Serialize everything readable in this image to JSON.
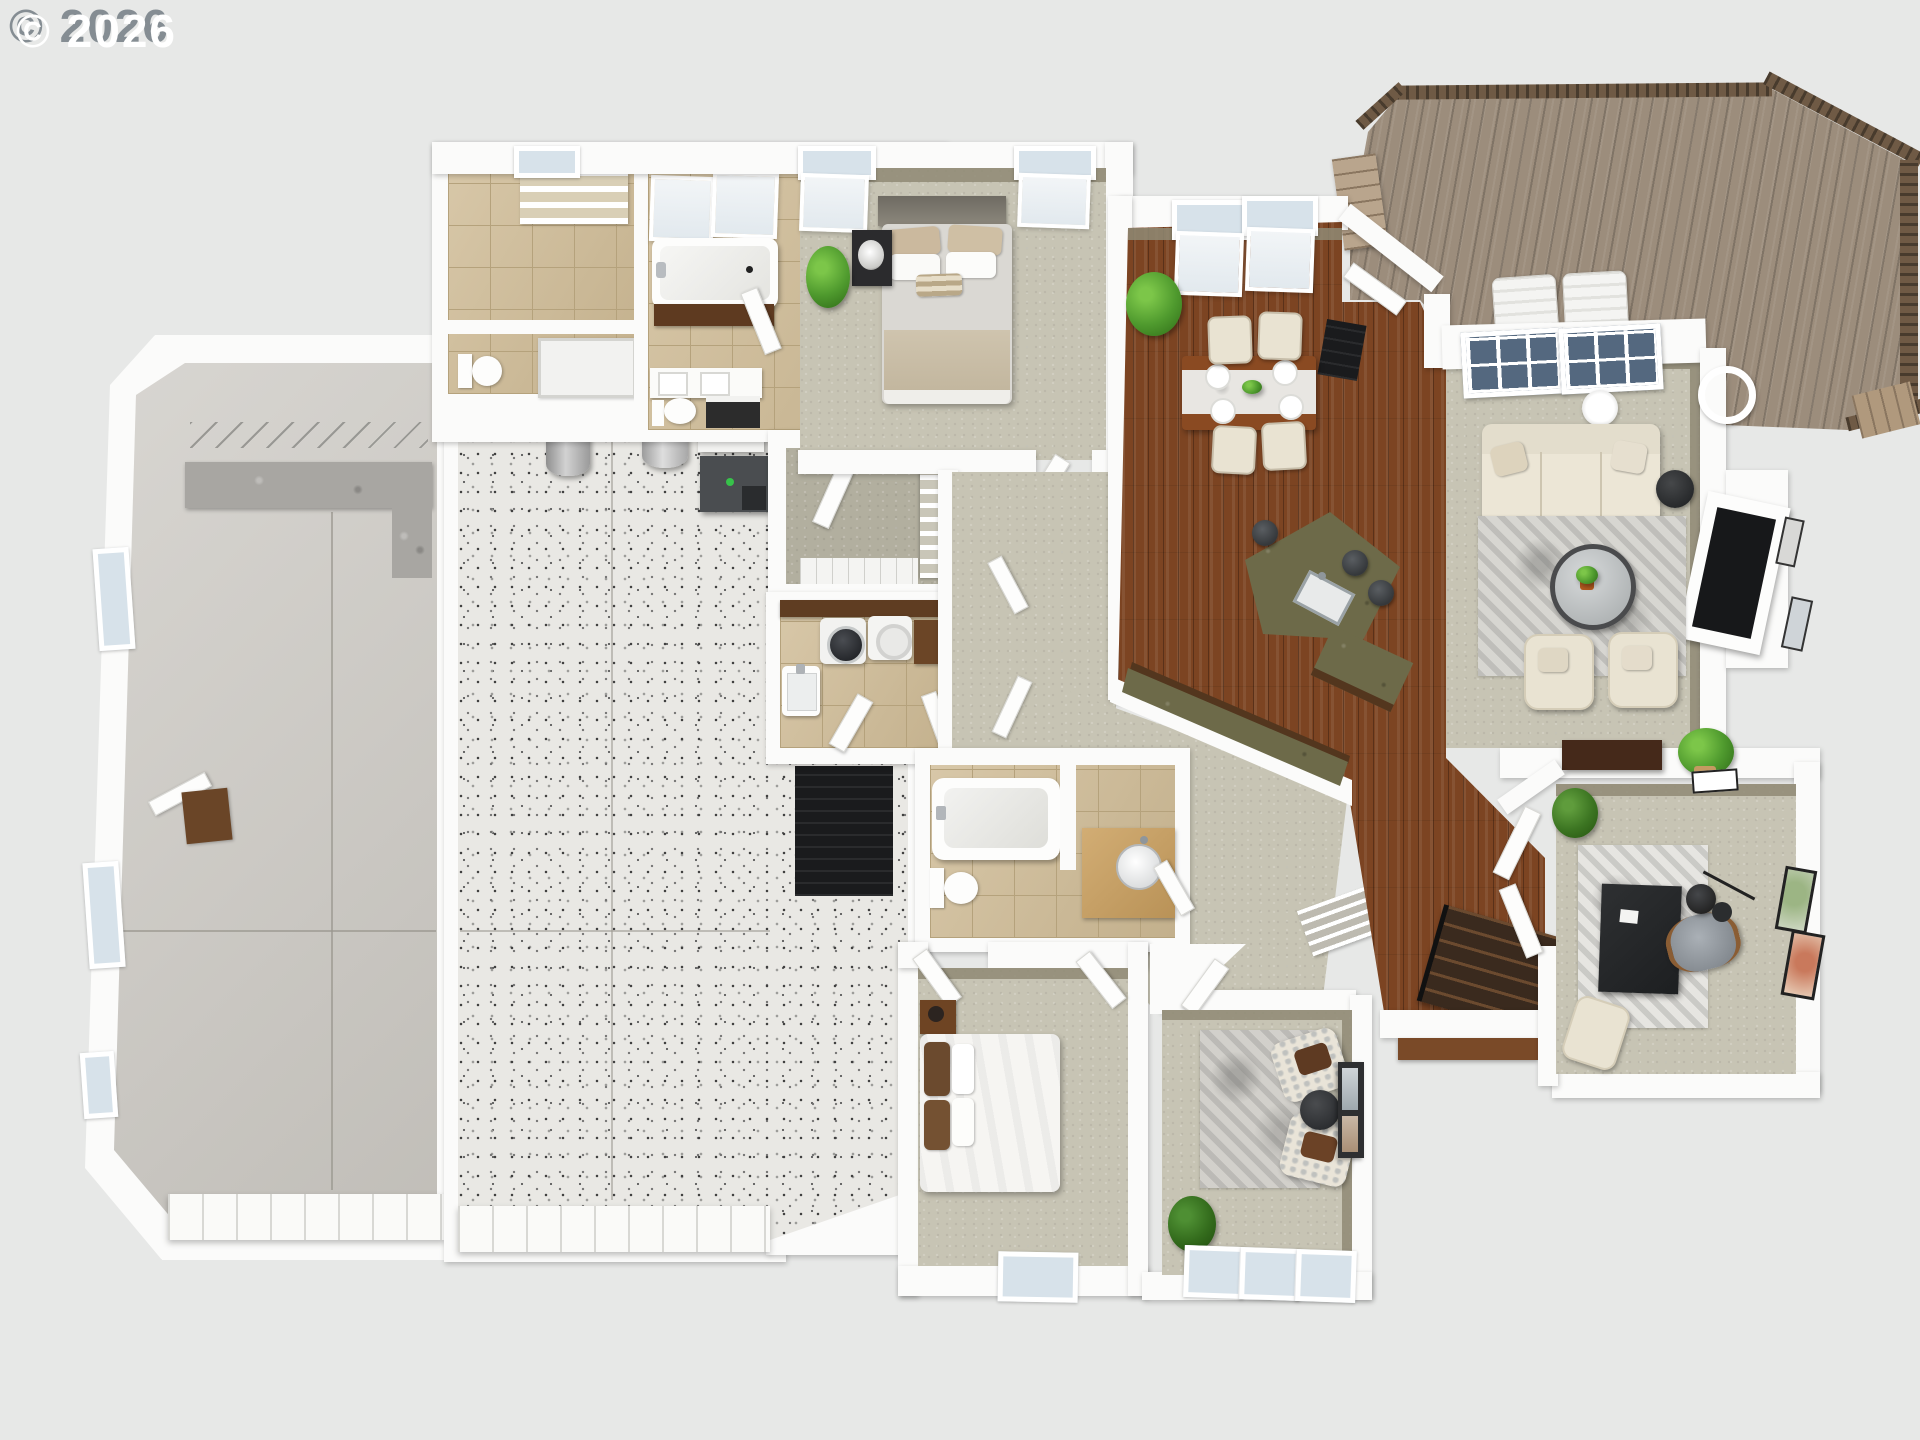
{
  "watermark": {
    "text": "© 2026"
  },
  "palette": {
    "bg": "#e7e8e7",
    "wall": "#fbfbfa",
    "inner_wall": "#8f8a74",
    "concrete": "#cbc8c2",
    "terrazzo": "#e9e8e4",
    "tile": "#cfbb95",
    "tile_line": "#b5a27c",
    "carpet": "#c7c4b4",
    "carpet_olive": "#b2af9f",
    "hardwood": "#7c4422",
    "deck": "#9c8d7c",
    "rail": "#6f5a45",
    "green_counter": "#6d6a49",
    "cabinet": "#53361e",
    "cream": "#e9e3d2",
    "rug": "#d7d6d1",
    "black": "#1a1b1d",
    "plant": "#4f9a2e",
    "glass": "#d7e2ea",
    "glass_dark": "#54687f"
  },
  "floorplan": {
    "type": "3d-rendered-floor-plan",
    "rooms": [
      {
        "name": "garage",
        "floor": "concrete",
        "features": [
          "workbench-counter",
          "wall-hooks",
          "side-windows",
          "service-door",
          "doormat",
          "garage-door"
        ]
      },
      {
        "name": "workshop",
        "floor": "terrazzo-speckle",
        "features": [
          "water-heater",
          "water-softener-tank",
          "furnace",
          "hvac-unit",
          "black-floor-pad",
          "garage-door"
        ]
      },
      {
        "name": "master-bathroom",
        "floor": "tan-tile",
        "features": [
          "garden-tub",
          "wood-tub-apron",
          "double-vanity",
          "toilet",
          "vanity-stool",
          "shower",
          "water-closet",
          "linen-shelves",
          "windows"
        ]
      },
      {
        "name": "walk-in-closet",
        "floor": "olive-carpet",
        "features": [
          "shelving-unit",
          "tiled-shower-strip",
          "door"
        ]
      },
      {
        "name": "master-bedroom",
        "floor": "carpet",
        "features": [
          "bed",
          "headboard",
          "pillows",
          "nightstand",
          "table-lamp",
          "potted-plant",
          "windows",
          "doors"
        ]
      },
      {
        "name": "laundry-room",
        "floor": "tan-tile",
        "features": [
          "counter",
          "top-load-washer",
          "dryer",
          "base-cabinet",
          "utility-sink",
          "doors"
        ]
      },
      {
        "name": "hall-bathroom",
        "floor": "tan-tile",
        "features": [
          "bathtub",
          "toilet",
          "vanity-round-sink",
          "door"
        ]
      },
      {
        "name": "hallway",
        "floor": "carpet",
        "features": [
          "linen-closet-wire-shelves",
          "wall-art",
          "doors"
        ]
      },
      {
        "name": "bedroom-2",
        "floor": "carpet",
        "features": [
          "bed-white-duvet",
          "brown-pillows",
          "nightstand",
          "lamp",
          "window",
          "door"
        ]
      },
      {
        "name": "sitting-room",
        "floor": "carpet",
        "features": [
          "two-patterned-armchairs",
          "brown-throw-pillows",
          "round-side-table",
          "area-rug",
          "leaning-art",
          "potted-plant",
          "three-windows"
        ]
      },
      {
        "name": "dining-area",
        "floor": "hardwood",
        "features": [
          "two-windows",
          "potted-plant",
          "dining-table-marble-runner",
          "four-place-settings",
          "greenery-centerpiece",
          "four-chairs",
          "deck-door",
          "doormat"
        ]
      },
      {
        "name": "kitchen",
        "floor": "hardwood",
        "features": [
          "angled-island-green-granite",
          "island-sink",
          "three-bar-stools",
          "perimeter-counter-brown-cabinets"
        ]
      },
      {
        "name": "entry",
        "floor": "hardwood",
        "features": [
          "staircase-black-railing",
          "front-porch-steps"
        ]
      },
      {
        "name": "living-room",
        "floor": "carpet",
        "features": [
          "sofa",
          "accent-pillows",
          "black-side-table",
          "pendant-lights",
          "area-rug",
          "round-coffee-table",
          "coffee-table-plant",
          "two-armchairs",
          "fireplace-media-unit",
          "wall-art",
          "console-table",
          "potted-plant",
          "two-picture-windows"
        ]
      },
      {
        "name": "office",
        "floor": "carpet",
        "features": [
          "black-desk",
          "office-chair",
          "arc-floor-lamp",
          "distressed-rug",
          "fern-plant",
          "lounge-chair",
          "two-wall-art-frames",
          "french-doors"
        ]
      },
      {
        "name": "deck",
        "floor": "wood-planks",
        "features": [
          "perimeter-railing",
          "two-adirondack-chairs",
          "stairs",
          "lower-landing"
        ]
      }
    ]
  }
}
